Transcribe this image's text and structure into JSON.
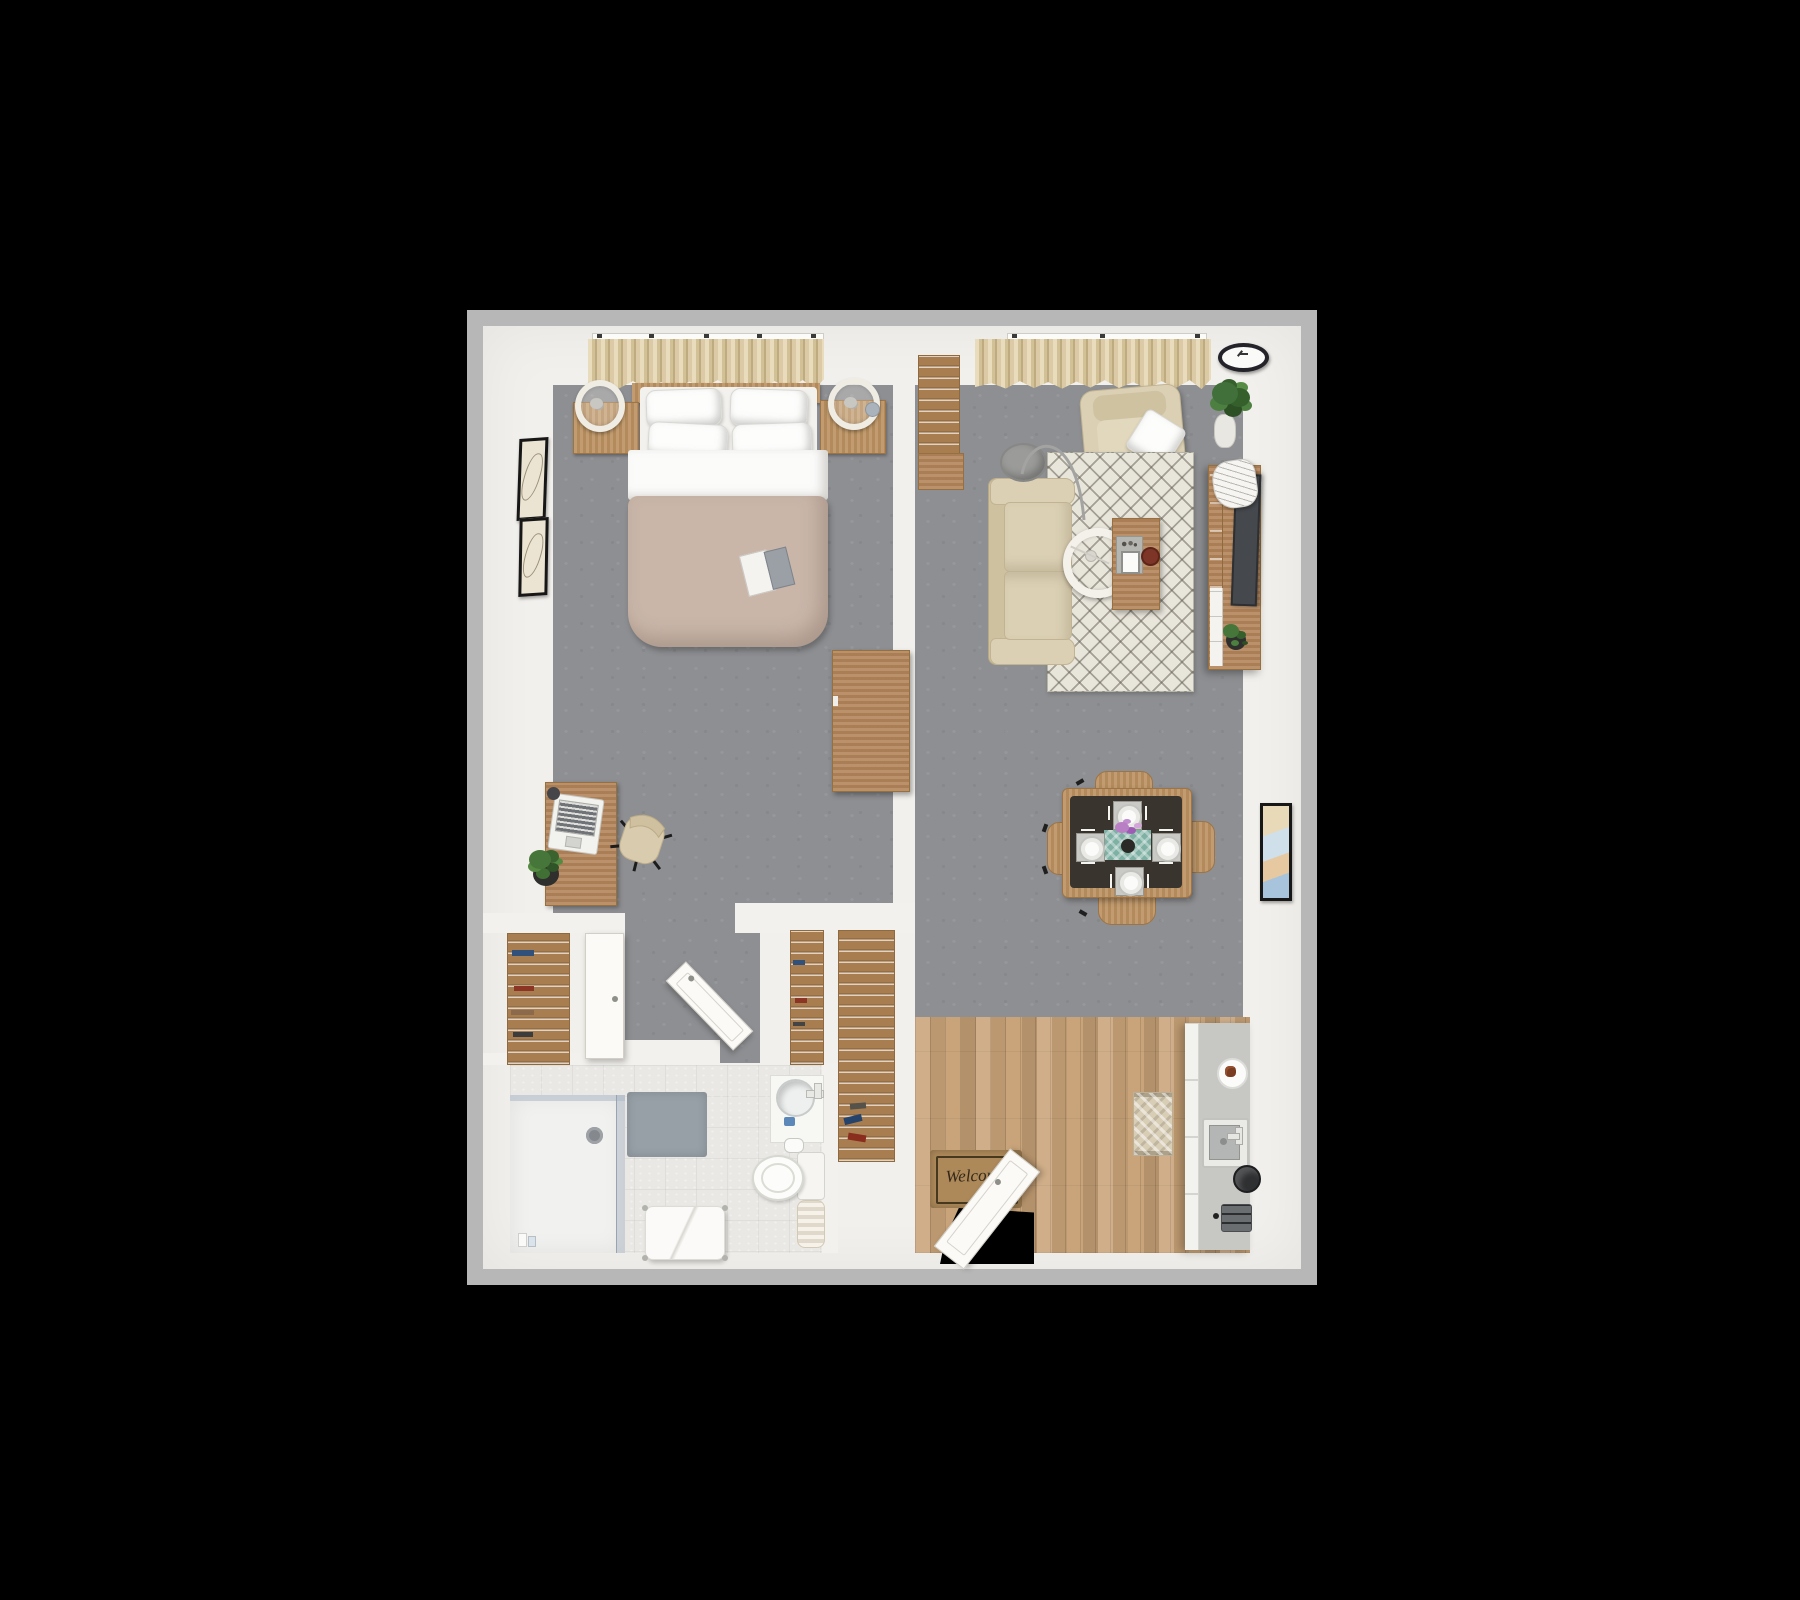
{
  "scene": {
    "kind": "3D top-down floor plan rendering",
    "apartment": "one-bedroom apartment",
    "background_color": "#000000"
  },
  "palette": {
    "outer_border": "#b7b7b7",
    "wall_white": "#f2f0ec",
    "carpet_gray": "#8e8f92",
    "bathroom_tile": "#e9e8e5",
    "kitchen_wood_floor": "#c7a176",
    "furniture_wood": "#bb9160",
    "upholstery_beige": "#dbd0b4",
    "duvet_taupe": "#c9b6a9",
    "rug_cream": "#e8e5db",
    "tv_screen": "#45484c",
    "plant_green": "#47763a",
    "table_runner_teal": "#7fb0a4",
    "welcome_mat_brown": "#ad895a",
    "bath_mat_gray": "#97a0a7"
  },
  "entry": {
    "welcome_mat_text": "Welcome"
  },
  "rooms": [
    {
      "name": "Bedroom",
      "items": [
        "double bed with four white pillows and taupe duvet",
        "wood headboard",
        "two wood nightstands",
        "two round ring lamps",
        "book on bed",
        "two black framed wall art prints",
        "curtained windows",
        "wood desk with laptop and potted plant",
        "office swivel chair",
        "wood dresser"
      ]
    },
    {
      "name": "Closets and hallway",
      "items": [
        "linen closet with wood shelves",
        "white closet door",
        "open white interior door",
        "second shelf closet",
        "tall wood pantry shelf with shoes"
      ]
    },
    {
      "name": "Bathroom",
      "items": [
        "walk-in glass shower with rain shower head",
        "gray bath mat",
        "vanity with round sink and faucet",
        "toilet paper holder",
        "toilet with tank",
        "towel bench with white towels",
        "cream storage cabinet"
      ]
    },
    {
      "name": "Living room",
      "items": [
        "beige sofa",
        "beige armchair with white throw pillow",
        "cream diamond-pattern area rug",
        "arc floor lamp with round shade",
        "ring pendant lamp",
        "wood coffee table with tray, tablet and bowl",
        "wood media console with flat TV, magazines and plant",
        "tall wood bookcase",
        "corner potted plant",
        "wall clock",
        "framed wall art"
      ]
    },
    {
      "name": "Dining area",
      "items": [
        "wood dining table with dark top",
        "four wood chairs",
        "four white place settings with cutlery",
        "teal table runner",
        "flower centerpiece"
      ]
    },
    {
      "name": "Kitchen / entry",
      "items": [
        "white cabinet run with counter",
        "plate with pastry",
        "square sink with faucet",
        "black kettle",
        "toaster",
        "beige kitchen mat",
        "plank wood floor",
        "welcome mat",
        "open white front door"
      ]
    }
  ]
}
